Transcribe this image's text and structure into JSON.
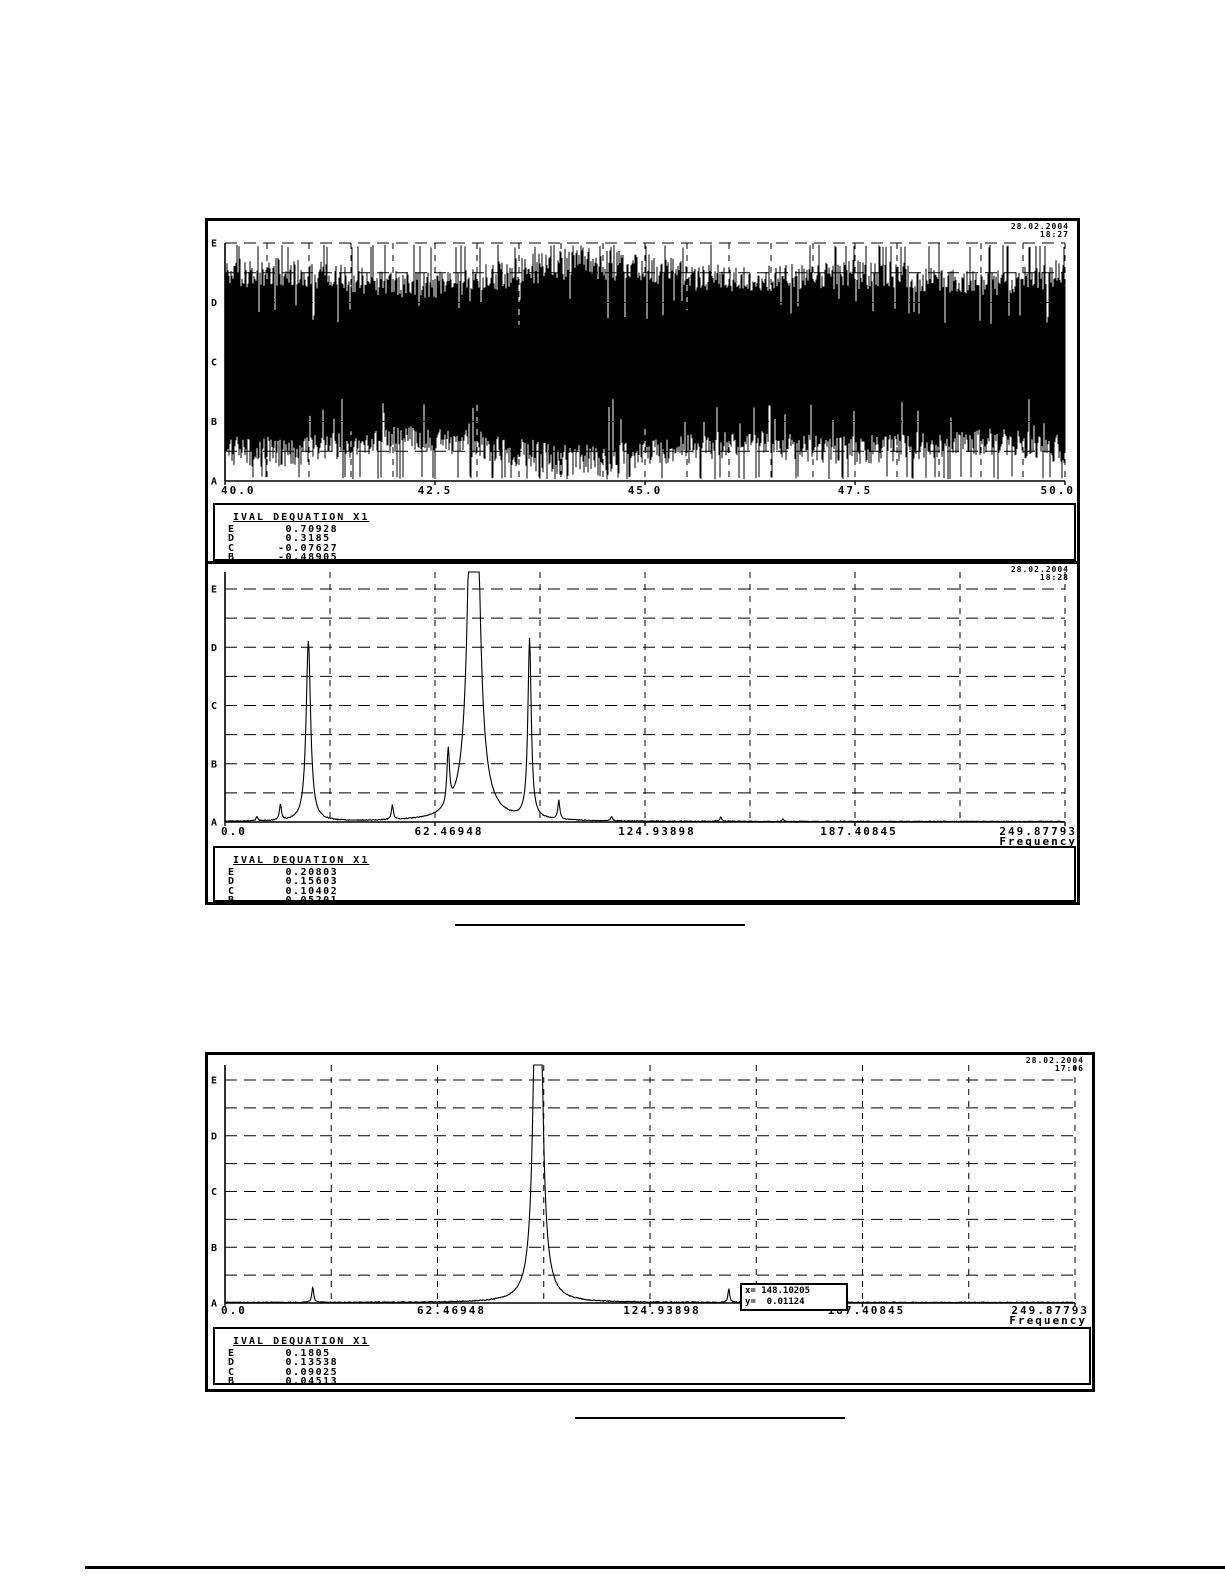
{
  "page": {
    "background": "#ffffff",
    "ink": "#000000"
  },
  "panels": [
    {
      "timestamp_date": "28.02.2004",
      "timestamp_time": "18:27",
      "legend": {
        "title": "IVAL DEQUATION X1",
        "rows": [
          [
            "E",
            " 0.70928"
          ],
          [
            "D",
            " 0.3185"
          ],
          [
            "C",
            "-0.07627"
          ],
          [
            "B",
            "-0.48905"
          ],
          [
            "A",
            "-0.88183"
          ]
        ]
      }
    },
    {
      "timestamp_date": "28.02.2004",
      "timestamp_time": "18:28",
      "legend": {
        "title": "IVAL DEQUATION X1",
        "rows": [
          [
            "E",
            " 0.20803"
          ],
          [
            "D",
            " 0.15603"
          ],
          [
            "C",
            " 0.10402"
          ],
          [
            "B",
            " 0.05201"
          ],
          [
            "A",
            " 0.0"
          ]
        ]
      }
    },
    {
      "timestamp_date": "28.02.2004",
      "timestamp_time": "17:06",
      "legend": {
        "title": "IVAL DEQUATION X1",
        "rows": [
          [
            "E",
            " 0.1805"
          ],
          [
            "D",
            " 0.13538"
          ],
          [
            "C",
            " 0.09025"
          ],
          [
            "B",
            " 0.04513"
          ],
          [
            "A",
            " 0.0"
          ]
        ]
      },
      "cursor_box": {
        "line1": "x= 148.10205",
        "line2": "y=  0.01124"
      }
    }
  ],
  "chart_data": [
    {
      "type": "line",
      "subtype": "time-waveform",
      "title": "",
      "xlabel": "",
      "x_range": [
        40.0,
        50.0
      ],
      "x_ticks": [
        "40.0",
        "42.5",
        "45.0",
        "47.5",
        "50.0"
      ],
      "y_level_labels": [
        "E",
        "D",
        "C",
        "B",
        "A"
      ],
      "y_level_values": [
        0.70928,
        0.3185,
        -0.07627,
        -0.48905,
        -0.88183
      ],
      "grid": "dashed horizontal lines at levels A-E and half-levels; fine dashed verticals every 0.5 units",
      "signal": "dense broadband oscillation filling nearly full scale between A and E, centered near C",
      "noise_seed": 11,
      "samples": 840
    },
    {
      "type": "line",
      "subtype": "frequency-spectrum",
      "title": "",
      "xlabel": "Frequency",
      "x_range": [
        0,
        249.87793
      ],
      "x_ticks": [
        "0.0",
        "62.46948",
        "124.93898",
        "187.40845",
        "249.87793"
      ],
      "y_level_labels": [
        "E",
        "D",
        "C",
        "B",
        "A"
      ],
      "y_level_values": [
        0.20803,
        0.15603,
        0.10402,
        0.05201,
        0.0
      ],
      "grid": "dashed grid, 8 vertical columns, dashed horizontals at half-levels",
      "noise_seed": 5,
      "peaks": [
        {
          "f": 9.5,
          "a": 0.004,
          "w": 0.3
        },
        {
          "f": 16.5,
          "a": 0.014,
          "w": 0.35
        },
        {
          "f": 24.8,
          "a": 0.161,
          "w": 0.8
        },
        {
          "f": 49.8,
          "a": 0.013,
          "w": 0.35
        },
        {
          "f": 66.4,
          "a": 0.05,
          "w": 0.45
        },
        {
          "f": 74.0,
          "a": 0.6,
          "w": 1.3
        },
        {
          "f": 90.6,
          "a": 0.16,
          "w": 0.6
        },
        {
          "f": 99.3,
          "a": 0.017,
          "w": 0.35
        },
        {
          "f": 115.0,
          "a": 0.004,
          "w": 0.3
        },
        {
          "f": 147.5,
          "a": 0.004,
          "w": 0.3
        },
        {
          "f": 166.0,
          "a": 0.002,
          "w": 0.25
        }
      ]
    },
    {
      "type": "line",
      "subtype": "frequency-spectrum",
      "title": "",
      "xlabel": "Frequency",
      "x_range": [
        0,
        249.87793
      ],
      "x_ticks": [
        "0.0",
        "62.46948",
        "124.93898",
        "187.40845",
        "249.87793"
      ],
      "y_level_labels": [
        "E",
        "D",
        "C",
        "B",
        "A"
      ],
      "y_level_values": [
        0.1805,
        0.13538,
        0.09025,
        0.04513,
        0.0
      ],
      "grid": "dashed grid, 8 vertical columns, dashed horizontals at half-levels",
      "noise_seed": 9,
      "peaks": [
        {
          "f": 25.8,
          "a": 0.013,
          "w": 0.3
        },
        {
          "f": 92.0,
          "a": 0.6,
          "w": 0.9
        },
        {
          "f": 148.10205,
          "a": 0.01124,
          "w": 0.3
        }
      ],
      "cursor": {
        "x": 148.10205,
        "y": 0.01124
      }
    }
  ]
}
